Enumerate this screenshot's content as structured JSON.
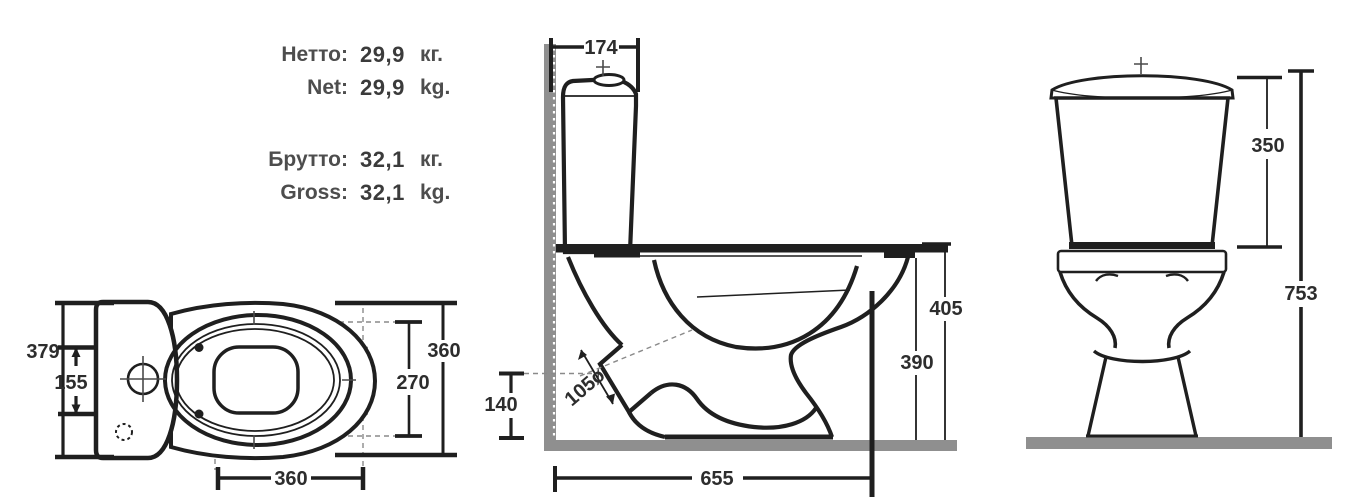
{
  "weights": {
    "net_ru": {
      "label": "Нетто:",
      "value": "29,9",
      "unit": "кг."
    },
    "net_en": {
      "label": "Net:",
      "value": "29,9",
      "unit": "kg."
    },
    "gross_ru": {
      "label": "Брутто:",
      "value": "32,1",
      "unit": "кг."
    },
    "gross_en": {
      "label": "Gross:",
      "value": "32,1",
      "unit": "kg."
    }
  },
  "top_view": {
    "dims": {
      "overall_width": "379",
      "mount_hole_spacing": "155",
      "bowl_width": "360",
      "seat_opening_depth": "270",
      "bowl_length": "360"
    }
  },
  "side_view": {
    "dims": {
      "tank_depth": "174",
      "outlet_height": "140",
      "outlet_diameter": "105ø",
      "seat_height": "405",
      "rim_height": "390",
      "overall_depth": "655"
    }
  },
  "front_view": {
    "dims": {
      "tank_height": "350",
      "overall_height": "753"
    }
  },
  "colors": {
    "line": "#1f1f1f",
    "surface_gray": "#8f8f8f",
    "dim_text": "#2d2d2d",
    "weight_text": "#4d4d4d"
  }
}
